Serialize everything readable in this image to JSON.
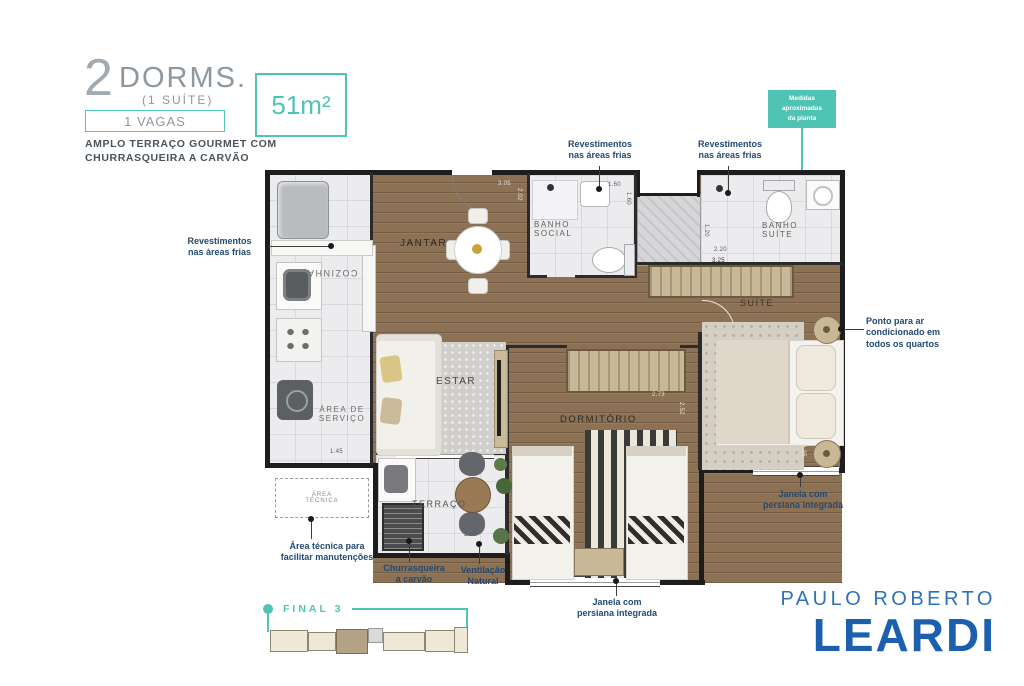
{
  "header": {
    "dorms_number": "2",
    "dorms_label": "DORMS.",
    "suite_label": "(1 SUÍTE)",
    "vagas_label": "1 VAGAS",
    "subtitle": "AMPLO TERRAÇO GOURMET COM\nCHURRASQUEIRA A CARVÃO",
    "area_label": "51m²"
  },
  "annotations": {
    "plan_disclaimer": "Medidas\naproximadas\nda planta",
    "revestimentos": "Revestimentos\nnas áreas frias",
    "ponto_ar": "Ponto para ar\ncondicionado em\ntodos os quartos",
    "janela_persiana": "Janela com\npersiana integrada",
    "area_tecnica": "Área técnica para\nfacilitar manutenções",
    "churrasqueira": "Churrasqueira\na carvão",
    "ventilacao": "Ventilação\nNatural"
  },
  "rooms": {
    "cozinha": "COZINHA",
    "jantar": "JANTAR",
    "estar": "ESTAR",
    "servico": "ÁREA DE\nSERVIÇO",
    "banho_social": "BANHO\nSOCIAL",
    "banho_suite": "BANHO\nSUÍTE",
    "suite": "SUÍTE",
    "dormitorio": "DORMITÓRIO",
    "terraco": "TERRAÇO",
    "area_tecnica_box": "ÁREA\nTÉCNICA"
  },
  "dims": {
    "jantar_w": "3.05",
    "jantar_h": "2.02",
    "banho_social_w": "1.60",
    "banho_social_h": "1.60",
    "banho_suite_h": "1.20",
    "banho_suite_w": "2.20",
    "closet_w": "3.25",
    "dorm_w": "2.73",
    "dorm_h": "2.52",
    "suite_h": "2.35",
    "terraco_w": "2.40",
    "servico_w": "1.45",
    "estar_h": "4.90"
  },
  "keyplan": {
    "final_label": "FINAL 3"
  },
  "brand": {
    "line1": "PAULO ROBERTO",
    "line2": "LEARDI"
  },
  "colors": {
    "teal": "#4fc4b4",
    "annotation_blue": "#214a72",
    "brand_blue": "#2d73b9",
    "brand_blue_dark": "#1b5fae"
  }
}
